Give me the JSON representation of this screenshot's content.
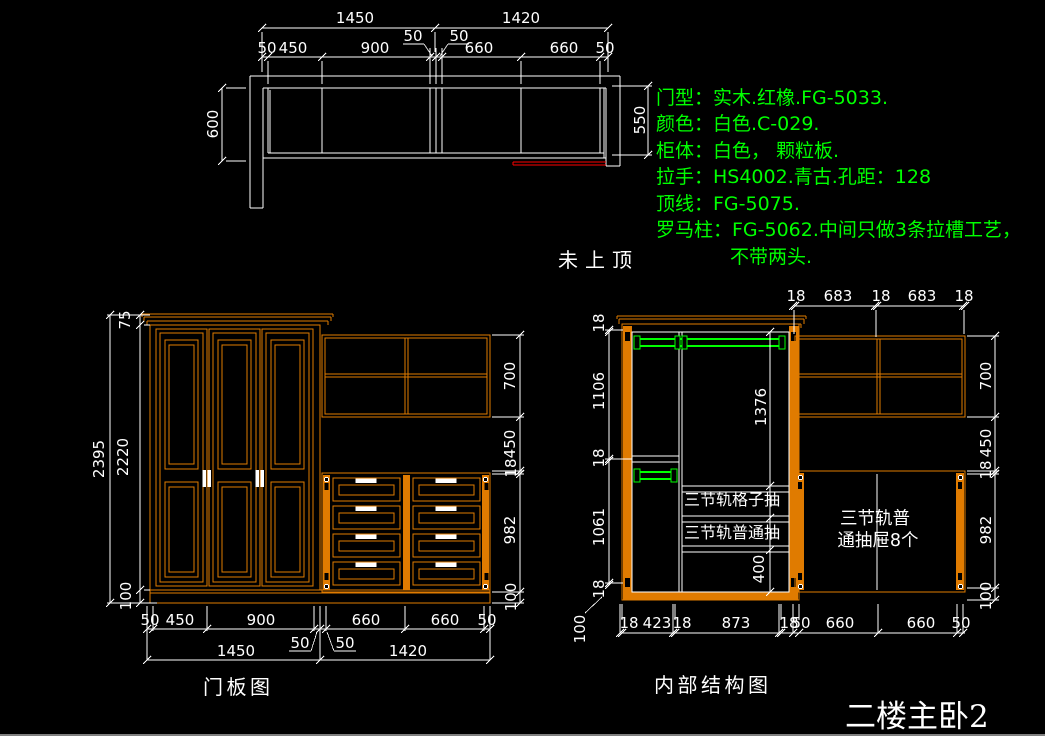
{
  "colors": {
    "background": "#000000",
    "line_white": "#ffffff",
    "cabinet_orange": "#e07b00",
    "note_green": "#00ff00",
    "highlight_red": "#ff0000"
  },
  "plan": {
    "width_left": "1450",
    "width_right": "1420",
    "filler_left": "50",
    "filler_right": "50",
    "segments": [
      "50",
      "450",
      "900",
      "660",
      "660",
      "50"
    ],
    "side_depth": "600",
    "cabinet_depth": "550",
    "ceiling_note": "未上顶"
  },
  "specs": {
    "lines": [
      "门型：实木.红橡.FG-5033.",
      "颜色：白色.C-029.",
      "柜体：白色，  颗粒板.",
      "拉手：HS4002.青古.孔距：128",
      "顶线：FG-5075.",
      "罗马柱：FG-5062.中间只做3条拉槽工艺，",
      "不带两头."
    ]
  },
  "door_view": {
    "title": "门板图",
    "overall_height": "2395",
    "crown_height": "75",
    "door_height": "2220",
    "base_height": "100",
    "right_chain": [
      "700",
      "450",
      "18",
      "982",
      "100"
    ],
    "bottom_segments": [
      "50",
      "450",
      "900",
      "660",
      "660",
      "50"
    ],
    "filler_left": "50",
    "filler_right": "50",
    "unit_left_width": "1450",
    "unit_right_width": "1420"
  },
  "internal_view": {
    "title": "内部结构图",
    "top_chain": [
      "18",
      "683",
      "18",
      "683",
      "18"
    ],
    "left_chain": [
      "18",
      "1106",
      "18",
      "1061",
      "18"
    ],
    "left_base": "100",
    "hang_height": "1376",
    "bottom_space": "400",
    "right_chain": [
      "700",
      "450",
      "18",
      "982",
      "100"
    ],
    "bottom_chain": [
      "18",
      "423",
      "18",
      "873",
      "18",
      "50",
      "660",
      "660",
      "50"
    ],
    "drawer_row_labels": [
      "三节轨格子抽",
      "三节轨普通抽"
    ],
    "drawer_note": [
      "三节轨普",
      "通抽屉8个"
    ]
  },
  "sheet": {
    "room_label": "二楼主卧2"
  }
}
